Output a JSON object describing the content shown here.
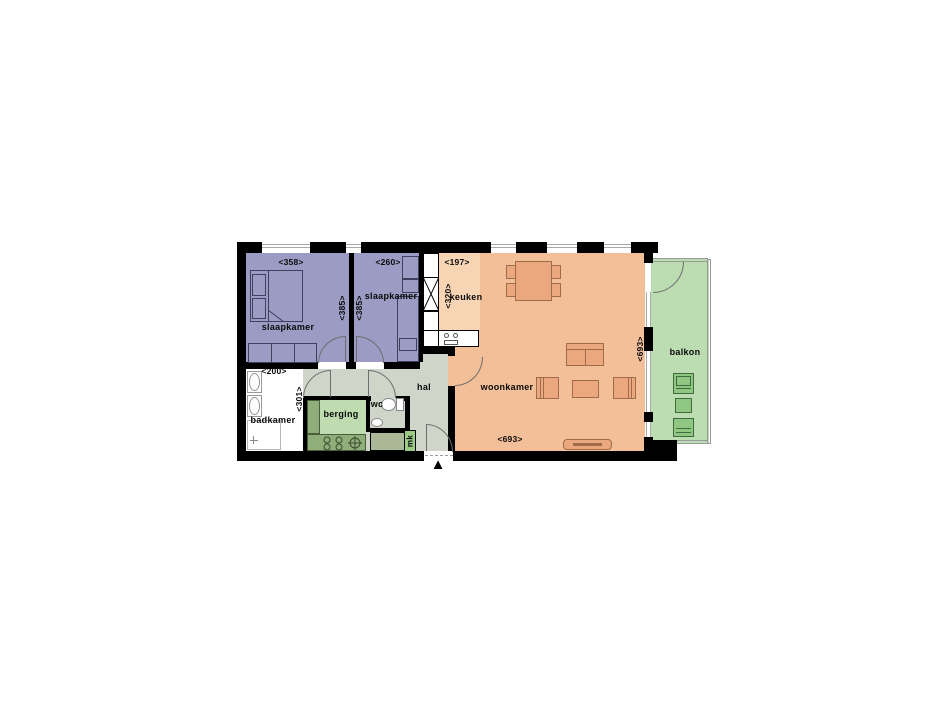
{
  "colors": {
    "wall": "#000000",
    "bedroom": "#9b9bc4",
    "kitchen": "#f7d4b4",
    "living": "#f2bf98",
    "balcony": "#bcdcb2",
    "balcony_dark": "#8fc681",
    "storage": "#bedcb0",
    "storage_dark": "#8fae79",
    "hall": "#d0d5c9",
    "meter": "#aab897",
    "meter_tab": "#9ccb85",
    "furn": "#eba87f",
    "furn_line": "#a06b49"
  },
  "rooms": {
    "bedroom1": {
      "label": "slaapkamer",
      "width": "<358>",
      "height": "<385>"
    },
    "bedroom2": {
      "label": "slaapkamer",
      "width": "<260>",
      "height": "<385>"
    },
    "kitchen": {
      "label": "keuken",
      "width": "<197>",
      "height": "<320>"
    },
    "living": {
      "label": "woonkamer",
      "width": "<693>",
      "height": "<693>"
    },
    "balcony": {
      "label": "balkon"
    },
    "bathroom": {
      "label": "badkamer",
      "width": "<200>",
      "height": "<301>"
    },
    "hall": {
      "label": "hal"
    },
    "storage": {
      "label": "berging"
    },
    "toilet": {
      "label": "wc"
    },
    "meter_cupboard": {
      "label": "mk"
    }
  },
  "icons": {
    "entrance_arrow": "▲"
  }
}
